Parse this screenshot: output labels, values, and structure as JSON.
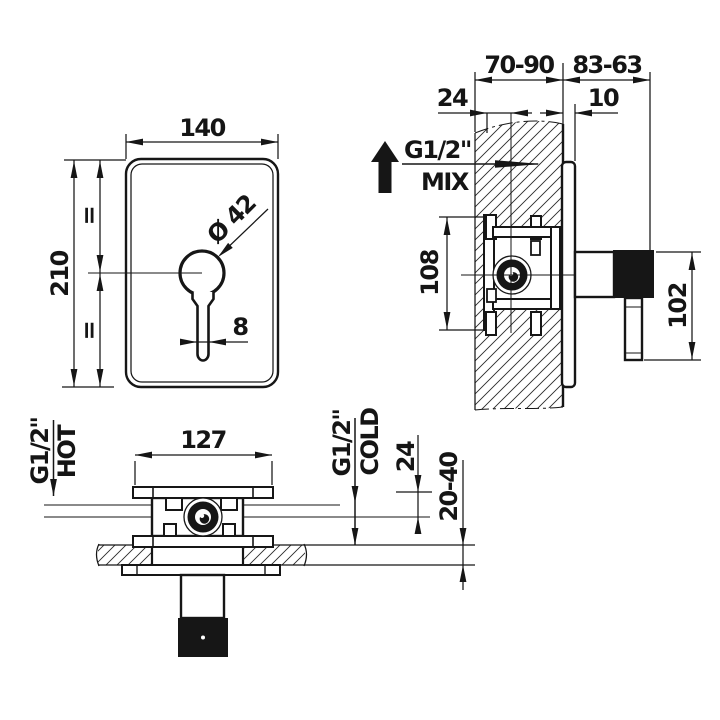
{
  "colors": {
    "ink": "#161616",
    "background": "#ffffff"
  },
  "front_view": {
    "plate_width": "140",
    "plate_height": "210",
    "knob_diameter": "Ø 42",
    "lever_width": "8",
    "equal_mark_top": "=",
    "equal_mark_bottom": "="
  },
  "side_view": {
    "wall_depth_range": "70-90",
    "handle_projection_range": "83-63",
    "center_inset": "24",
    "plate_offset": "10",
    "mix_thread": "G1/2\"",
    "mix_label": "MIX",
    "bracket_height": "108",
    "handle_length": "102"
  },
  "bottom_view": {
    "bracket_width": "127",
    "hot_thread": "G1/2\"",
    "hot_label": "HOT",
    "cold_thread": "G1/2\"",
    "cold_label": "COLD",
    "port_depth": "24",
    "wall_thickness_range": "20-40"
  }
}
